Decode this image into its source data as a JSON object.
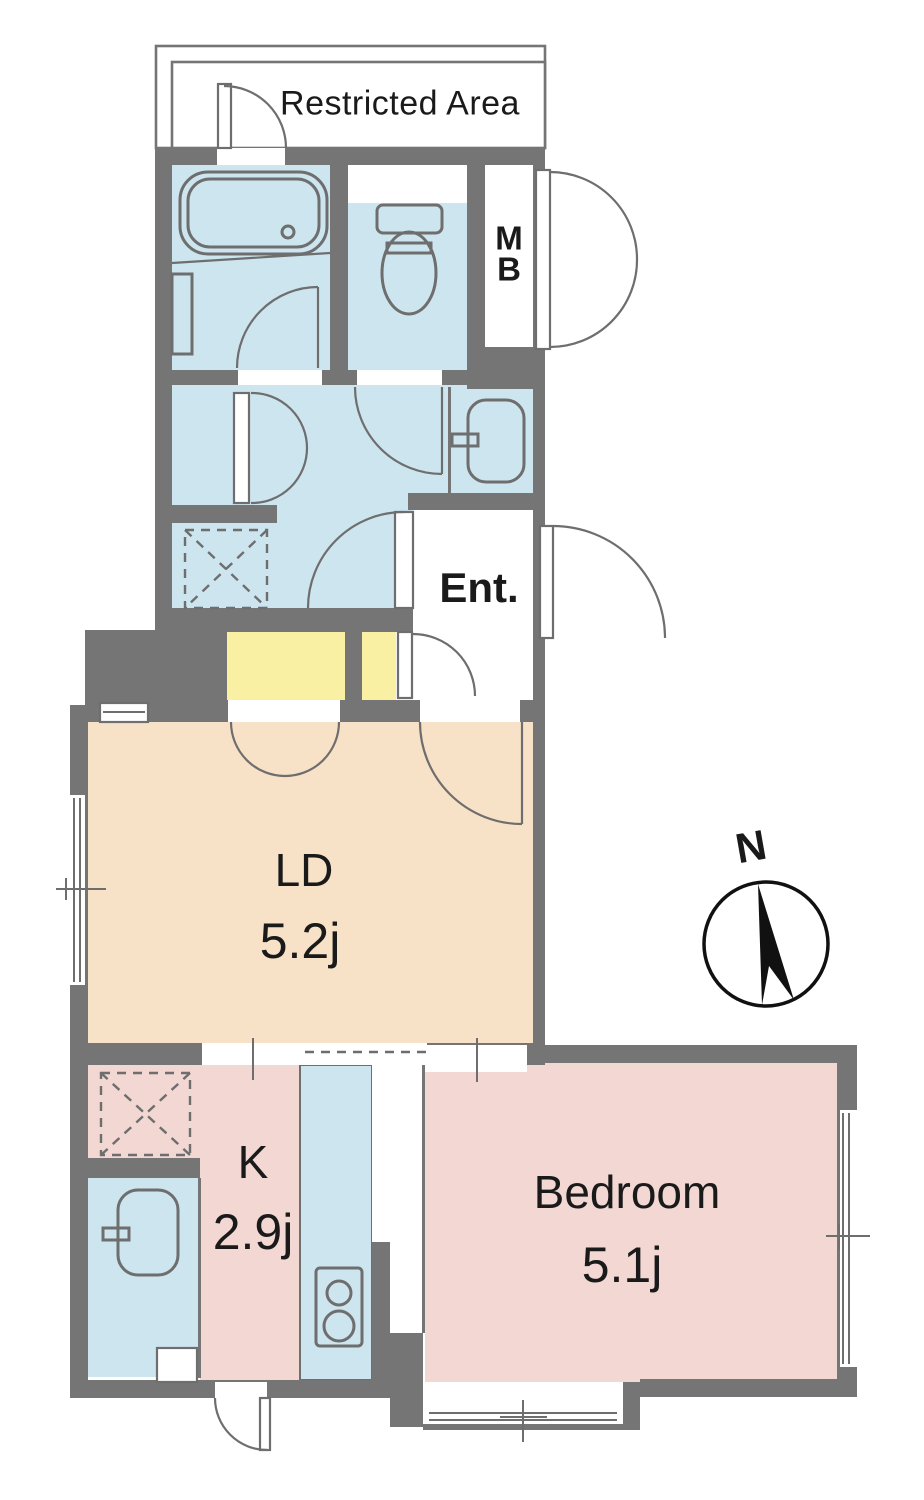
{
  "plan": {
    "restricted_area": {
      "label": "Restricted Area"
    },
    "rooms": {
      "meter_box": {
        "line1": "M",
        "line2": "B"
      },
      "entrance": {
        "label": "Ent."
      },
      "living_dining": {
        "label": "LD",
        "size": "5.2j"
      },
      "kitchen": {
        "label": "K",
        "size": "2.9j"
      },
      "bedroom": {
        "label": "Bedroom",
        "size": "5.1j"
      }
    },
    "compass": {
      "label": "N"
    }
  },
  "colors": {
    "wall": "#757575",
    "water": "#cde5ef",
    "ld": "#f7e2c7",
    "room": "#f2d7d3",
    "closet": "#f9f0a4",
    "line": "#6e6e6e",
    "text": "#1a1a1a",
    "bg": "#ffffff"
  }
}
